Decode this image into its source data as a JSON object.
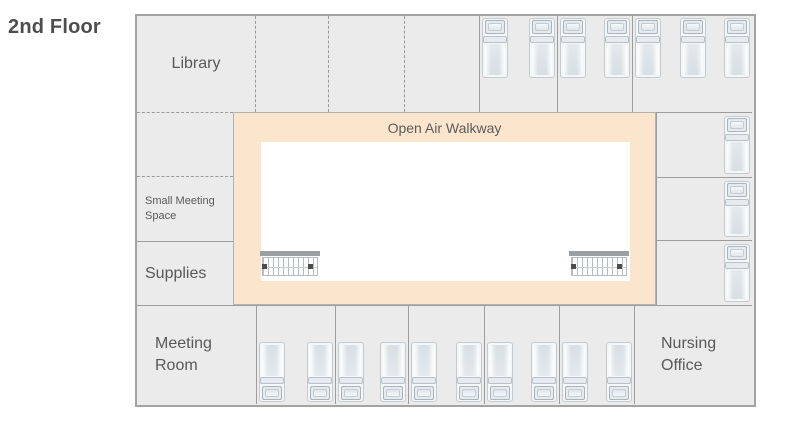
{
  "title": "2nd Floor",
  "floorplan": {
    "walkway": {
      "label": "Open Air Walkway"
    },
    "rooms": {
      "library": {
        "label": "Library"
      },
      "small_meeting": {
        "label": "Small Meeting Space"
      },
      "supplies": {
        "label": "Supplies"
      },
      "meeting_room": {
        "label": "Meeting Room"
      },
      "nursing_office": {
        "label": "Nursing Office"
      }
    },
    "bedrooms": [
      {
        "slot": "top-1",
        "beds": 2,
        "pillow": "up",
        "layout": "row-top"
      },
      {
        "slot": "top-2",
        "beds": 2,
        "pillow": "up",
        "layout": "row-top"
      },
      {
        "slot": "top-3",
        "beds": 3,
        "pillow": "up",
        "layout": "row-top"
      },
      {
        "slot": "right-1",
        "beds": 1,
        "pillow": "up",
        "layout": "col-right"
      },
      {
        "slot": "right-2",
        "beds": 1,
        "pillow": "up",
        "layout": "col-right"
      },
      {
        "slot": "right-3",
        "beds": 1,
        "pillow": "up",
        "layout": "col-right"
      },
      {
        "slot": "bottom-1",
        "beds": 2,
        "pillow": "down",
        "layout": "row-bottom"
      },
      {
        "slot": "bottom-2",
        "beds": 2,
        "pillow": "down",
        "layout": "row-bottom"
      },
      {
        "slot": "bottom-3",
        "beds": 2,
        "pillow": "down",
        "layout": "row-bottom"
      },
      {
        "slot": "bottom-4",
        "beds": 2,
        "pillow": "down",
        "layout": "row-bottom"
      },
      {
        "slot": "bottom-5",
        "beds": 2,
        "pillow": "down",
        "layout": "row-bottom"
      }
    ],
    "features": [
      {
        "type": "stairs",
        "position": "bottom-left"
      },
      {
        "type": "stairs",
        "position": "bottom-right"
      }
    ]
  },
  "colors": {
    "walkway_fill": "#fce5cd",
    "room_fill": "#ebebeb",
    "wall": "#a3a3a3",
    "label_text": "#595959",
    "title_text": "#4d4d4d"
  }
}
